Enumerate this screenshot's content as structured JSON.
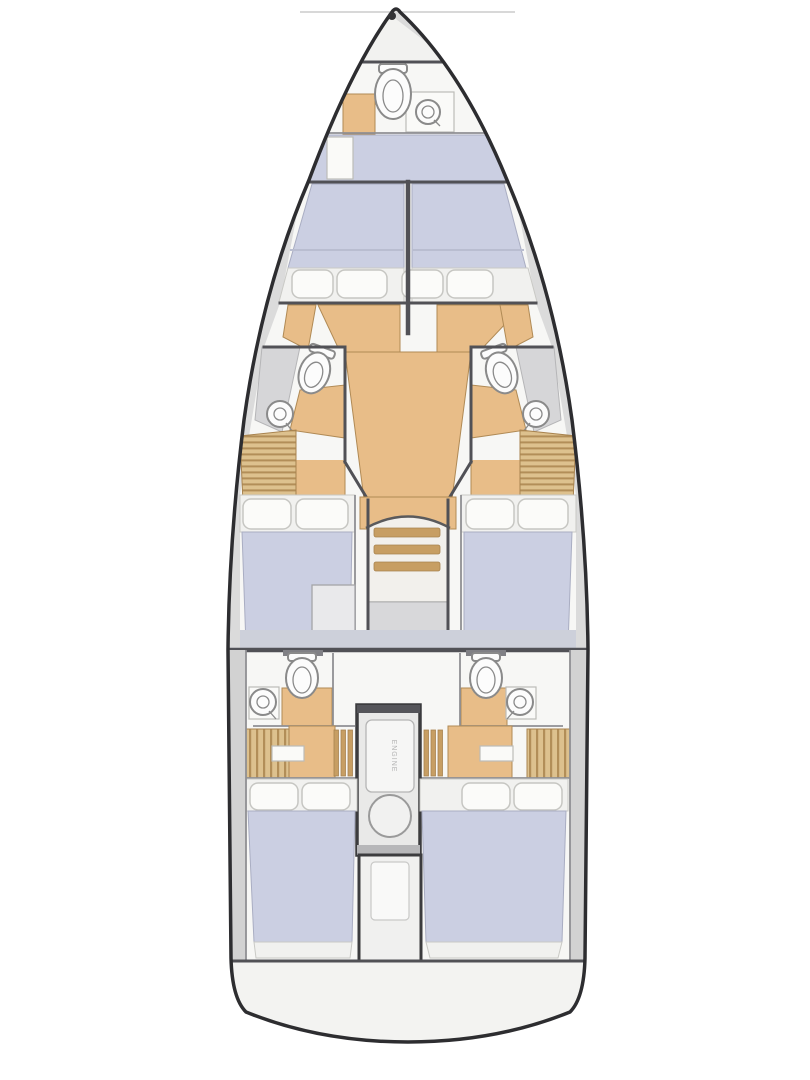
{
  "figure": {
    "type": "yacht-interior-floorplan",
    "engine_label": "ENGINE",
    "colors": {
      "hull-line": "#2d2d30",
      "deck": "#dbdbdb",
      "floor": "#f7f7f5",
      "wood": "#e8bd88",
      "wood-dark": "#c79e63",
      "mattress": "#cbcfe2",
      "mattress-foot": "#f1f1ef",
      "pillow": "#fbfbf9",
      "wall": "#515156",
      "fixture": "#fcfcfc",
      "fixture-line": "#8a8a8a",
      "locker-base": "#ddc18e",
      "locker-stripe": "#b28e58",
      "landing": "#d8d8da",
      "engine-frame": "#3c3c3e",
      "platform": "#f3f3f1"
    }
  }
}
